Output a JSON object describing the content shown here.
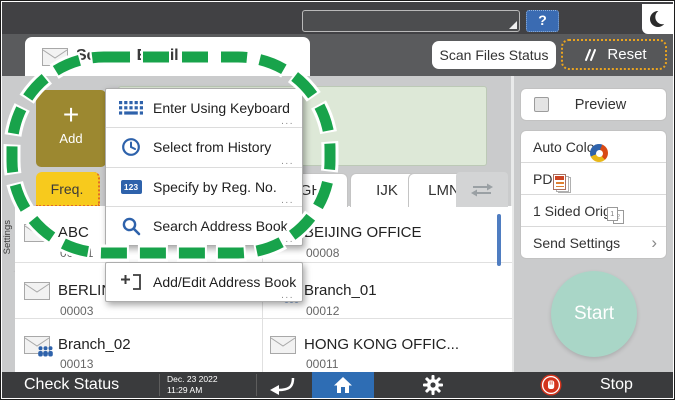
{
  "top_bar": {
    "help": "?"
  },
  "header": {
    "title": "Scan to Email",
    "scan_files_status": "Scan Files Status",
    "reset": "Reset"
  },
  "left_panel": {
    "add_plus": "+",
    "add_label": "Add",
    "freq_tab": "Freq.",
    "side_tab": "Settings"
  },
  "alpha_tabs": {
    "t1": "GH",
    "t2": "IJK",
    "t3": "LMN"
  },
  "popup": {
    "items": [
      {
        "label": "Enter Using Keyboard",
        "more": "..."
      },
      {
        "label": "Select from History",
        "more": "..."
      },
      {
        "label": "Specify by Reg. No.",
        "more": "...",
        "badge": "123"
      },
      {
        "label": "Search Address Book",
        "more": "..."
      }
    ],
    "footer": {
      "label": "Add/Edit Address Book",
      "more": "..."
    }
  },
  "address_list": {
    "rows": [
      {
        "left": {
          "name": "ABC",
          "num": "00001"
        },
        "right": {
          "name": "BEIJING OFFICE",
          "num": "00008"
        }
      },
      {
        "left": {
          "name": "BERLIN OFFICE",
          "num": "00003"
        },
        "right": {
          "name": "Branch_01",
          "num": "00012"
        }
      },
      {
        "left": {
          "name": "Branch_02",
          "num": "00013"
        },
        "right": {
          "name": "HONG KONG OFFIC...",
          "num": "00011"
        }
      }
    ]
  },
  "right_panel": {
    "preview": "Preview",
    "settings": [
      {
        "label": "Auto Color"
      },
      {
        "label": "PDF"
      },
      {
        "label": "1 Sided Orig.",
        "page1": "1",
        "page2": "2"
      },
      {
        "label": "Send Settings",
        "chevron": "›"
      }
    ],
    "start": "Start"
  },
  "bottom_bar": {
    "check_status": "Check Status",
    "date": "Dec. 23 2022",
    "time": "11:29 AM",
    "stop": "Stop"
  },
  "colors": {
    "accent_blue": "#2e62ab",
    "freq_yellow": "#f7ca1d",
    "add_gold": "#9c8830",
    "start_teal": "#a9d6c7",
    "ring_green": "#18a34b",
    "reset_border": "#eaa41f",
    "stop_red": "#d3341d",
    "home_blue": "#2e6db4"
  }
}
